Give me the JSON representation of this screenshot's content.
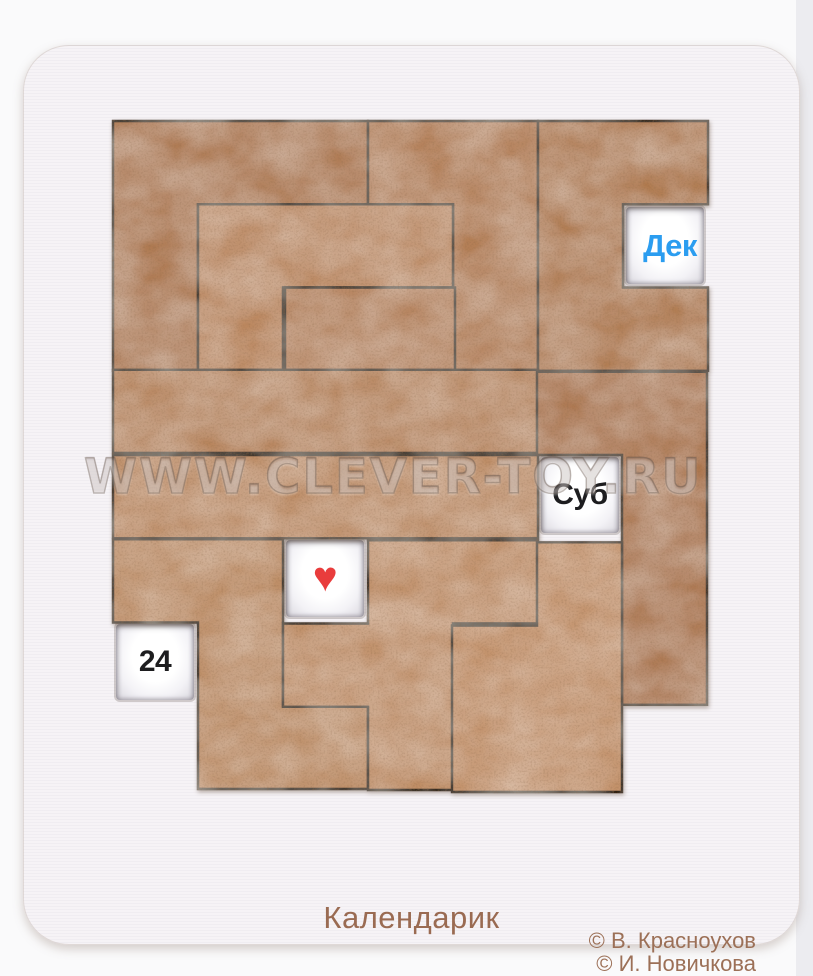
{
  "product": {
    "title": "Календарик",
    "credits": [
      "© В. Красноухов",
      "© И. Новичкова"
    ],
    "watermark": "WWW.CLEVER-TOY.RU"
  },
  "board": {
    "grid": {
      "cols": 7,
      "rows": 8,
      "origin_x": 113,
      "origin_y": 121,
      "cell_w": 85,
      "cell_h": 83.25
    },
    "colors": {
      "seam": "#2b1a0e",
      "board_surface": "#f6f3f6",
      "window_face": "#ffffff",
      "month_text": "#2b9df0",
      "weekday_text": "#1d1d1f",
      "date_text": "#1d1d1f",
      "heart": "#e93c3c",
      "engraving": "#9a6b52"
    },
    "windows": [
      {
        "id": "month",
        "label": "Дек",
        "col": 6,
        "row": 1,
        "text_color": "#2b9df0"
      },
      {
        "id": "weekday",
        "label": "Суб",
        "col": 5,
        "row": 4,
        "text_color": "#1d1d1f"
      },
      {
        "id": "heart",
        "label": "♥",
        "col": 2,
        "row": 5,
        "text_color": "#e93c3c"
      },
      {
        "id": "date",
        "label": "24",
        "col": 0,
        "row": 6,
        "text_color": "#1d1d1f"
      }
    ],
    "pieces": [
      {
        "id": "v-corner",
        "shape": "V-pentomino",
        "fill": "#ae7850",
        "dx": 0,
        "dy": 0,
        "outline": [
          [
            0,
            0
          ],
          [
            3,
            0
          ],
          [
            3,
            1
          ],
          [
            1,
            1
          ],
          [
            1,
            3
          ],
          [
            0,
            3
          ]
        ]
      },
      {
        "id": "j-top",
        "shape": "J-tetromino",
        "fill": "#b47f57",
        "dx": 0,
        "dy": 0,
        "outline": [
          [
            3,
            0
          ],
          [
            5,
            0
          ],
          [
            5,
            3
          ],
          [
            4,
            3
          ],
          [
            4,
            1
          ],
          [
            3,
            1
          ]
        ]
      },
      {
        "id": "u-right",
        "shape": "U-pentomino",
        "fill": "#b07a50",
        "dx": 0,
        "dy": 0,
        "outline": [
          [
            5,
            0
          ],
          [
            7,
            0
          ],
          [
            7,
            1
          ],
          [
            6,
            1
          ],
          [
            6,
            2
          ],
          [
            7,
            2
          ],
          [
            7,
            3
          ],
          [
            5,
            3
          ]
        ]
      },
      {
        "id": "j-middle",
        "shape": "J-tetromino",
        "fill": "#bb875e",
        "dx": 0,
        "dy": 0,
        "outline": [
          [
            1,
            1
          ],
          [
            4,
            1
          ],
          [
            4,
            2
          ],
          [
            2,
            2
          ],
          [
            2,
            3
          ],
          [
            1,
            3
          ]
        ]
      },
      {
        "id": "domino",
        "shape": "domino",
        "fill": "#b5815a",
        "dx": 2,
        "dy": 0,
        "outline": [
          [
            2,
            2
          ],
          [
            4,
            2
          ],
          [
            4,
            3
          ],
          [
            2,
            3
          ]
        ]
      },
      {
        "id": "bar-upper",
        "shape": "I-pentomino",
        "fill": "#b8855d",
        "dx": 0,
        "dy": -1,
        "outline": [
          [
            0,
            3
          ],
          [
            5,
            3
          ],
          [
            5,
            4
          ],
          [
            0,
            4
          ]
        ]
      },
      {
        "id": "l-right",
        "shape": "L-pentomino",
        "fill": "#ab7349",
        "dx": -1,
        "dy": 1,
        "outline": [
          [
            5,
            3
          ],
          [
            7,
            3
          ],
          [
            7,
            7
          ],
          [
            6,
            7
          ],
          [
            6,
            4
          ],
          [
            5,
            4
          ]
        ]
      },
      {
        "id": "bar-lower",
        "shape": "I-pentomino",
        "fill": "#bc8961",
        "dx": 0,
        "dy": 1,
        "outline": [
          [
            0,
            4
          ],
          [
            5,
            4
          ],
          [
            5,
            5
          ],
          [
            0,
            5
          ]
        ]
      },
      {
        "id": "n-left",
        "shape": "N-pentomino",
        "fill": "#bc8a61",
        "dx": 0,
        "dy": 2,
        "outline": [
          [
            0,
            5
          ],
          [
            2,
            5
          ],
          [
            2,
            7
          ],
          [
            3,
            7
          ],
          [
            3,
            8
          ],
          [
            1,
            8
          ],
          [
            1,
            6
          ],
          [
            0,
            6
          ]
        ]
      },
      {
        "id": "f-bottom",
        "shape": "F-pentomino",
        "fill": "#c08e66",
        "dx": 0,
        "dy": 3,
        "outline": [
          [
            3,
            5
          ],
          [
            5,
            5
          ],
          [
            5,
            6
          ],
          [
            4,
            6
          ],
          [
            4,
            8
          ],
          [
            3,
            8
          ],
          [
            3,
            7
          ],
          [
            2,
            7
          ],
          [
            2,
            6
          ],
          [
            3,
            6
          ]
        ]
      },
      {
        "id": "p-bottomright",
        "shape": "P-pentomino",
        "fill": "#c29068",
        "dx": -1,
        "dy": 5,
        "outline": [
          [
            5,
            5
          ],
          [
            6,
            5
          ],
          [
            6,
            8
          ],
          [
            4,
            8
          ],
          [
            4,
            6
          ],
          [
            5,
            6
          ]
        ]
      }
    ]
  }
}
